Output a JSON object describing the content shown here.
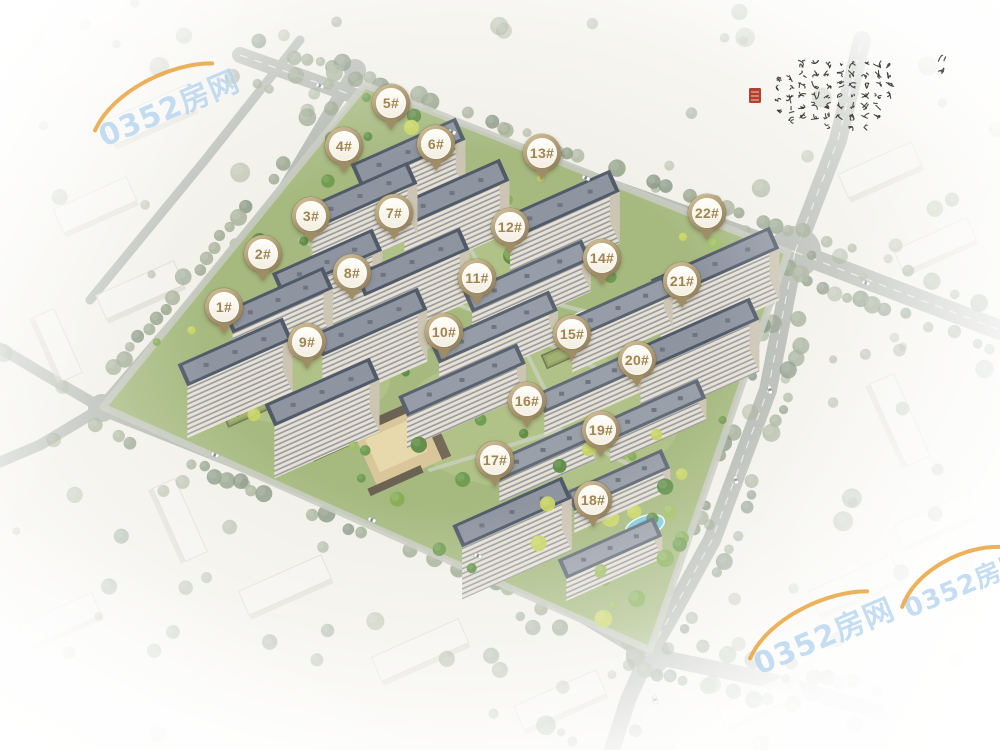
{
  "watermark": {
    "text": "0352房网",
    "text_color": "rgba(148,193,232,0.55)",
    "swoosh_color": "#e9a33e",
    "instances": [
      {
        "x": 168,
        "y": 106,
        "rot": -23,
        "size": 30
      },
      {
        "x": 823,
        "y": 634,
        "rot": -23,
        "size": 30
      },
      {
        "x": 965,
        "y": 583,
        "rot": -23,
        "size": 26
      }
    ]
  },
  "calligraphy": {
    "ink_color": "#35322c",
    "seal_color": "#b3402e",
    "area": {
      "x": 746,
      "y": 46,
      "w": 212,
      "h": 96
    }
  },
  "markers": {
    "ring_color": "#b2a07a",
    "text_color": "#a08450",
    "fill_color": "#fdfcf6",
    "items": [
      {
        "label": "1#",
        "x": 224,
        "y": 307
      },
      {
        "label": "2#",
        "x": 263,
        "y": 254
      },
      {
        "label": "3#",
        "x": 311,
        "y": 216
      },
      {
        "label": "4#",
        "x": 344,
        "y": 146
      },
      {
        "label": "5#",
        "x": 391,
        "y": 103
      },
      {
        "label": "6#",
        "x": 436,
        "y": 144
      },
      {
        "label": "7#",
        "x": 394,
        "y": 213
      },
      {
        "label": "8#",
        "x": 352,
        "y": 273
      },
      {
        "label": "9#",
        "x": 307,
        "y": 342
      },
      {
        "label": "10#",
        "x": 444,
        "y": 332
      },
      {
        "label": "11#",
        "x": 477,
        "y": 278
      },
      {
        "label": "12#",
        "x": 510,
        "y": 227
      },
      {
        "label": "13#",
        "x": 542,
        "y": 153
      },
      {
        "label": "14#",
        "x": 602,
        "y": 258
      },
      {
        "label": "15#",
        "x": 572,
        "y": 334
      },
      {
        "label": "16#",
        "x": 527,
        "y": 401
      },
      {
        "label": "17#",
        "x": 495,
        "y": 460
      },
      {
        "label": "18#",
        "x": 593,
        "y": 500
      },
      {
        "label": "19#",
        "x": 601,
        "y": 430
      },
      {
        "label": "20#",
        "x": 637,
        "y": 360
      },
      {
        "label": "21#",
        "x": 682,
        "y": 281
      },
      {
        "label": "22#",
        "x": 707,
        "y": 213
      }
    ]
  },
  "scene": {
    "palette": {
      "compound_green": "#a6ba80",
      "road": "#b6bab3",
      "road_line": "rgba(255,255,255,0.65)",
      "ghost_block": "#f4f3ee",
      "facade": "#e6e1d4",
      "facade_end": "#cdc5b4",
      "pool": "#7fcbdc",
      "plaza_tan": "#d9c69a",
      "plaza_inner": "#e8d9ad",
      "green_roof": "#93a465"
    },
    "compound": [
      [
        365,
        85
      ],
      [
        788,
        252
      ],
      [
        650,
        650
      ],
      [
        103,
        407
      ]
    ],
    "roads": [
      {
        "pts": [
          [
            240,
            55
          ],
          [
            500,
            148
          ],
          [
            795,
            252
          ]
        ],
        "w": 16,
        "dash": true
      },
      {
        "pts": [
          [
            795,
            252
          ],
          [
            838,
            140
          ],
          [
            862,
            40
          ]
        ],
        "w": 18,
        "dash": true
      },
      {
        "pts": [
          [
            795,
            252
          ],
          [
            900,
            292
          ],
          [
            1000,
            330
          ]
        ],
        "w": 20,
        "dash": true
      },
      {
        "pts": [
          [
            795,
            252
          ],
          [
            768,
            390
          ],
          [
            712,
            540
          ],
          [
            668,
            620
          ],
          [
            648,
            655
          ]
        ],
        "w": 18,
        "dash": true
      },
      {
        "pts": [
          [
            648,
            655
          ],
          [
            628,
            700
          ],
          [
            612,
            750
          ]
        ],
        "w": 16,
        "dash": false
      },
      {
        "pts": [
          [
            648,
            655
          ],
          [
            760,
            678
          ],
          [
            880,
            712
          ]
        ],
        "w": 16,
        "dash": false
      },
      {
        "pts": [
          [
            102,
            408
          ],
          [
            320,
            495
          ],
          [
            505,
            568
          ],
          [
            648,
            655
          ]
        ],
        "w": 15,
        "dash": true
      },
      {
        "pts": [
          [
            355,
            70
          ],
          [
            285,
            188
          ],
          [
            195,
            300
          ],
          [
            102,
            408
          ]
        ],
        "w": 13,
        "dash": false
      },
      {
        "pts": [
          [
            102,
            408
          ],
          [
            40,
            372
          ],
          [
            0,
            348
          ]
        ],
        "w": 11,
        "dash": false
      },
      {
        "pts": [
          [
            102,
            408
          ],
          [
            40,
            445
          ],
          [
            0,
            462
          ]
        ],
        "w": 11,
        "dash": false
      },
      {
        "pts": [
          [
            300,
            40
          ],
          [
            205,
            160
          ],
          [
            90,
            300
          ]
        ],
        "w": 9,
        "dash": false
      }
    ],
    "junctions": [
      [
        795,
        252,
        26
      ],
      [
        648,
        655,
        22
      ],
      [
        102,
        408,
        14
      ],
      [
        355,
        70,
        11
      ]
    ],
    "buildings": [
      {
        "label": "1#",
        "x": 235,
        "y": 352,
        "l": 115,
        "kind": "tall"
      },
      {
        "label": "2#",
        "x": 278,
        "y": 300,
        "l": 110,
        "kind": "tall"
      },
      {
        "label": "3#",
        "x": 327,
        "y": 262,
        "l": 110,
        "kind": "tall"
      },
      {
        "label": "4#",
        "x": 360,
        "y": 196,
        "l": 115,
        "kind": "tall"
      },
      {
        "label": "5#",
        "x": 408,
        "y": 152,
        "l": 115,
        "kind": "tall"
      },
      {
        "label": "6#",
        "x": 452,
        "y": 193,
        "l": 115,
        "kind": "tall"
      },
      {
        "label": "7#",
        "x": 412,
        "y": 262,
        "l": 115,
        "kind": "tall"
      },
      {
        "label": "8#",
        "x": 370,
        "y": 322,
        "l": 115,
        "kind": "tall"
      },
      {
        "label": "9#",
        "x": 322,
        "y": 392,
        "l": 115,
        "kind": "tall"
      },
      {
        "label": "10#",
        "x": 462,
        "y": 380,
        "l": 130,
        "kind": "mid"
      },
      {
        "label": "11#",
        "x": 494,
        "y": 327,
        "l": 130,
        "kind": "mid"
      },
      {
        "label": "12#",
        "x": 527,
        "y": 276,
        "l": 130,
        "kind": "mid"
      },
      {
        "label": "13#",
        "x": 560,
        "y": 205,
        "l": 120,
        "kind": "tall"
      },
      {
        "label": "14#",
        "x": 618,
        "y": 308,
        "l": 110,
        "kind": "mid"
      },
      {
        "label": "15#",
        "x": 588,
        "y": 382,
        "l": 105,
        "kind": "low"
      },
      {
        "label": "16#",
        "x": 543,
        "y": 450,
        "l": 105,
        "kind": "low"
      },
      {
        "label": "17#",
        "x": 512,
        "y": 512,
        "l": 120,
        "kind": "tall"
      },
      {
        "label": "18#",
        "x": 610,
        "y": 548,
        "l": 105,
        "kind": "low"
      },
      {
        "label": "19#",
        "x": 618,
        "y": 480,
        "l": 105,
        "kind": "low"
      },
      {
        "label": "20#",
        "x": 654,
        "y": 410,
        "l": 105,
        "kind": "low"
      },
      {
        "label": "21#",
        "x": 695,
        "y": 335,
        "l": 130,
        "kind": "tall"
      },
      {
        "label": "22#",
        "x": 715,
        "y": 264,
        "l": 130,
        "kind": "tall"
      }
    ],
    "pools": [
      {
        "x": 299,
        "y": 431,
        "rx": 8,
        "ry": 8,
        "rot": 0
      },
      {
        "x": 312,
        "y": 444,
        "rx": 6,
        "ry": 6,
        "rot": 0
      },
      {
        "x": 583,
        "y": 321,
        "rx": 16,
        "ry": 9,
        "rot": -20
      },
      {
        "x": 645,
        "y": 526,
        "rx": 20,
        "ry": 10,
        "rot": -18
      },
      {
        "x": 497,
        "y": 395,
        "rx": 14,
        "ry": 5,
        "rot": -24
      }
    ],
    "plaza": {
      "x": 402,
      "y": 446,
      "w": 78,
      "h": 58
    },
    "green_roofs": [
      {
        "x": 253,
        "y": 405,
        "w": 62,
        "h": 20
      },
      {
        "x": 332,
        "y": 444,
        "w": 46,
        "h": 16
      },
      {
        "x": 560,
        "y": 355,
        "w": 34,
        "h": 14
      }
    ],
    "ghost_blocks": [
      {
        "x": 150,
        "y": 115,
        "w": 90,
        "h": 26,
        "r": -24
      },
      {
        "x": 95,
        "y": 205,
        "w": 80,
        "h": 26,
        "r": -24
      },
      {
        "x": 140,
        "y": 290,
        "w": 85,
        "h": 26,
        "r": -24
      },
      {
        "x": 58,
        "y": 345,
        "w": 70,
        "h": 22,
        "r": 66
      },
      {
        "x": 880,
        "y": 170,
        "w": 80,
        "h": 26,
        "r": -24
      },
      {
        "x": 935,
        "y": 245,
        "w": 80,
        "h": 24,
        "r": -24
      },
      {
        "x": 900,
        "y": 420,
        "w": 90,
        "h": 26,
        "r": 66
      },
      {
        "x": 935,
        "y": 520,
        "w": 80,
        "h": 24,
        "r": -24
      },
      {
        "x": 855,
        "y": 585,
        "w": 90,
        "h": 26,
        "r": -24
      },
      {
        "x": 285,
        "y": 585,
        "w": 90,
        "h": 26,
        "r": -24
      },
      {
        "x": 180,
        "y": 520,
        "w": 80,
        "h": 24,
        "r": 66
      },
      {
        "x": 420,
        "y": 650,
        "w": 95,
        "h": 26,
        "r": -24
      },
      {
        "x": 560,
        "y": 700,
        "w": 90,
        "h": 26,
        "r": -24
      },
      {
        "x": 760,
        "y": 700,
        "w": 85,
        "h": 24,
        "r": -24
      },
      {
        "x": 60,
        "y": 620,
        "w": 80,
        "h": 24,
        "r": -24
      }
    ],
    "cars": [
      {
        "x": 320,
        "y": 86,
        "a": 19
      },
      {
        "x": 452,
        "y": 132,
        "a": 19
      },
      {
        "x": 586,
        "y": 178,
        "a": 19
      },
      {
        "x": 866,
        "y": 283,
        "a": 17
      },
      {
        "x": 770,
        "y": 390,
        "a": 82
      },
      {
        "x": 736,
        "y": 480,
        "a": 76
      },
      {
        "x": 215,
        "y": 455,
        "a": 21
      },
      {
        "x": 372,
        "y": 520,
        "a": 21
      },
      {
        "x": 478,
        "y": 556,
        "a": 21
      },
      {
        "x": 655,
        "y": 700,
        "a": 80
      }
    ]
  }
}
